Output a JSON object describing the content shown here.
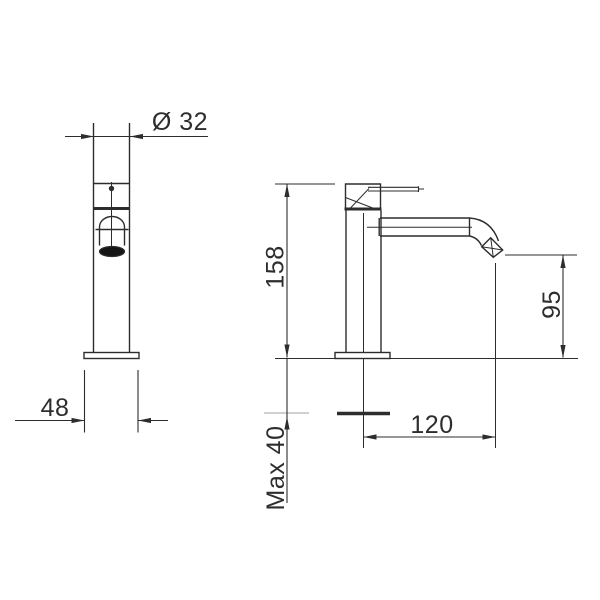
{
  "colors": {
    "line": "#2d2d2d",
    "faint": "#b5b5b5",
    "background": "#ffffff",
    "aerator": "#161616"
  },
  "dimensions": {
    "spout_diameter": {
      "label": "Ø 32",
      "value": 32
    },
    "base_width": {
      "label": "48",
      "value": 48
    },
    "total_height": {
      "label": "158",
      "value": 158
    },
    "outlet_height": {
      "label": "95",
      "value": 95
    },
    "spout_reach": {
      "label": "120",
      "value": 120
    },
    "max_mounting_thickness": {
      "label": "Max 40",
      "value": 40
    }
  }
}
